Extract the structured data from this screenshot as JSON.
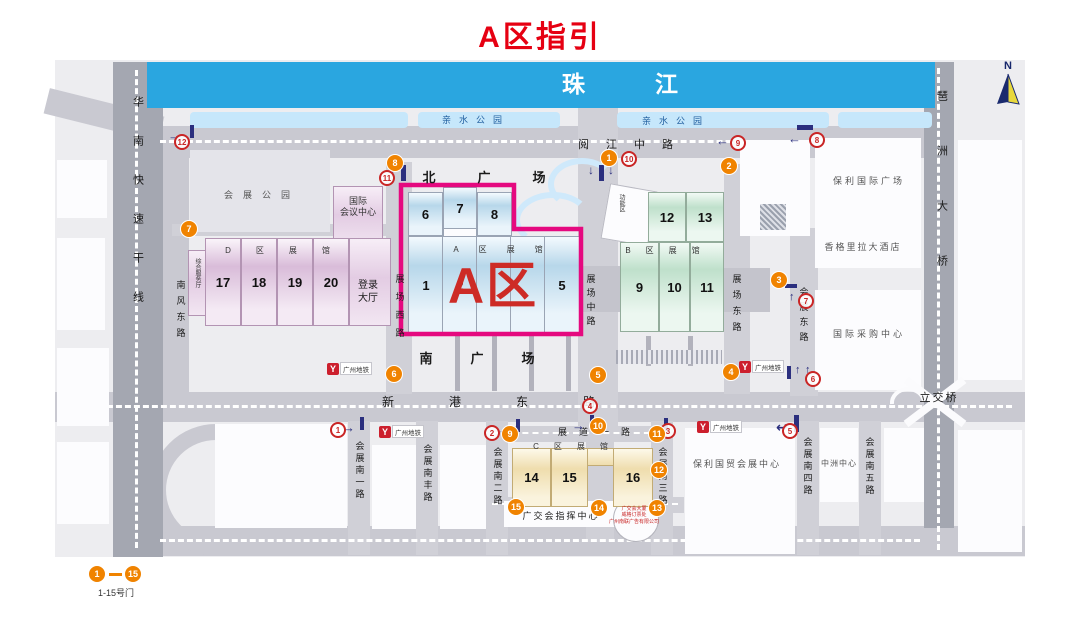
{
  "title": "A区指引",
  "legend": {
    "from": "1",
    "to": "15",
    "label": "1-15号门"
  },
  "colors": {
    "title_red": "#e60012",
    "accent_magenta": "#e5097f",
    "gate_orange": "#f08300",
    "river_blue": "#2aa6e0",
    "entry_marker_red": "#c92525",
    "arrow_navy": "#2b2f7e",
    "hall_a_blue": "#b7d7ea",
    "hall_b_green": "#bfe0cb",
    "hall_c_yellow": "#efddad",
    "hall_d_pink": "#d9bcd9"
  },
  "map": {
    "area_a_label": "A区",
    "metro": {
      "label": "广州地铁",
      "positions": [
        {
          "x": 327,
          "y": 362
        },
        {
          "x": 379,
          "y": 425
        },
        {
          "x": 739,
          "y": 360
        },
        {
          "x": 697,
          "y": 420
        }
      ]
    },
    "labels": [
      {
        "id": "pearl-river",
        "t": "珠江",
        "x": 655,
        "y": 70,
        "s": 23,
        "ls": 70,
        "c": "#ffffff",
        "b": 1
      },
      {
        "id": "waterfront-park-1",
        "t": "亲水公园",
        "x": 476,
        "y": 115,
        "s": 9,
        "ls": 8,
        "c": "#1d5c9e"
      },
      {
        "id": "waterfront-park-2",
        "t": "亲水公园",
        "x": 676,
        "y": 116,
        "s": 9,
        "ls": 8,
        "c": "#1d5c9e"
      },
      {
        "id": "yuejiang-middle-rd",
        "t": "阅江中路",
        "x": 634,
        "y": 139,
        "s": 11,
        "ls": 17
      },
      {
        "id": "huanan-expressway",
        "t": "华南快速干线",
        "x": 137,
        "y": 96,
        "s": 11,
        "ls": 28,
        "v": 1
      },
      {
        "id": "nanfeng-east-rd",
        "t": "南风东路",
        "x": 180,
        "y": 280,
        "s": 9,
        "ls": 7,
        "v": 1
      },
      {
        "id": "exhibition-park",
        "t": "会展公园",
        "x": 262,
        "y": 190,
        "s": 9,
        "ls": 10,
        "c": "#555555"
      },
      {
        "id": "intl-convention-center",
        "t": [
          "国际",
          "会议中心"
        ],
        "x": 358,
        "y": 196,
        "s": 9,
        "c": "#333333"
      },
      {
        "id": "area-d-hall-row",
        "t": "D区展馆",
        "x": 290,
        "y": 246,
        "s": 8,
        "ls": 25,
        "c": "#333333"
      },
      {
        "id": "service-hall",
        "t": "综合服务厅",
        "x": 197,
        "y": 258,
        "s": 6,
        "v": 1,
        "c": "#333333"
      },
      {
        "id": "registration-hall",
        "t": [
          "登录",
          "大厅"
        ],
        "x": 368,
        "y": 280,
        "s": 10
      },
      {
        "id": "zhanchang-west-rd",
        "t": "展场西路",
        "x": 399,
        "y": 274,
        "s": 9,
        "ls": 9,
        "v": 1
      },
      {
        "id": "north-plaza",
        "t": "北广场",
        "x": 505,
        "y": 170,
        "s": 13,
        "ls": 42,
        "b": 1
      },
      {
        "id": "area-a-hall-row",
        "t": "A区展馆",
        "x": 508,
        "y": 245,
        "s": 8,
        "ls": 20,
        "c": "#333333"
      },
      {
        "id": "zhanchang-middle-rd",
        "t": "展场中路",
        "x": 590,
        "y": 274,
        "s": 9,
        "ls": 5,
        "v": 1
      },
      {
        "id": "area-b-hall-row",
        "t": "B区展馆",
        "x": 670,
        "y": 246,
        "s": 8,
        "ls": 15,
        "c": "#333333"
      },
      {
        "id": "function-zone",
        "t": "功能区",
        "x": 621,
        "y": 194,
        "s": 6,
        "v": 1,
        "c": "#333333"
      },
      {
        "id": "zhanchang-east-rd",
        "t": "展场东路",
        "x": 736,
        "y": 274,
        "s": 9,
        "ls": 7,
        "v": 1
      },
      {
        "id": "huizhan-east-rd",
        "t": "会展东路",
        "x": 803,
        "y": 287,
        "s": 9,
        "ls": 6,
        "v": 1
      },
      {
        "id": "poly-intl-plaza",
        "t": "保利国际广场",
        "x": 869,
        "y": 176,
        "s": 9,
        "ls": 3,
        "c": "#555555"
      },
      {
        "id": "shangri-la-hotel",
        "t": "香格里拉大酒店",
        "x": 863,
        "y": 242,
        "s": 9,
        "ls": 2,
        "c": "#555555"
      },
      {
        "id": "intl-sourcing-center",
        "t": "国际采购中心",
        "x": 869,
        "y": 329,
        "s": 9,
        "ls": 3,
        "c": "#555555"
      },
      {
        "id": "pazhou-bridge",
        "t": "琶洲大桥",
        "x": 941,
        "y": 90,
        "s": 11,
        "ls": 44,
        "v": 1
      },
      {
        "id": "south-plaza",
        "t": "南广场",
        "x": 496,
        "y": 351,
        "s": 13,
        "ls": 38,
        "b": 1
      },
      {
        "id": "xingang-east-rd",
        "t": "新港东路",
        "x": 516,
        "y": 395,
        "s": 12,
        "ls": 55
      },
      {
        "id": "overpass",
        "t": "立交桥",
        "x": 939,
        "y": 392,
        "s": 11,
        "ls": 2
      },
      {
        "id": "zhandao-first-rd",
        "t": "展道一路",
        "x": 600,
        "y": 427,
        "s": 9,
        "ls": 12
      },
      {
        "id": "huizhan-south-1-rd",
        "t": "会展南一路",
        "x": 359,
        "y": 441,
        "s": 9,
        "ls": 3,
        "v": 1
      },
      {
        "id": "huizhan-south-feng-rd",
        "t": "会展南丰路",
        "x": 427,
        "y": 444,
        "s": 9,
        "ls": 3,
        "v": 1
      },
      {
        "id": "huizhan-south-2-rd",
        "t": "会展南二路",
        "x": 497,
        "y": 447,
        "s": 9,
        "ls": 3,
        "v": 1
      },
      {
        "id": "area-c-hall-row",
        "t": "C区展馆",
        "x": 578,
        "y": 442,
        "s": 8,
        "ls": 15,
        "c": "#333333"
      },
      {
        "id": "huizhan-south-3-rd",
        "t": "会展南三路",
        "x": 662,
        "y": 447,
        "s": 9,
        "ls": 3,
        "v": 1
      },
      {
        "id": "poly-trade-center",
        "t": "保利国贸会展中心",
        "x": 737,
        "y": 459,
        "s": 9,
        "ls": 2,
        "c": "#555555"
      },
      {
        "id": "huizhan-south-4-rd",
        "t": "会展南四路",
        "x": 807,
        "y": 437,
        "s": 9,
        "ls": 3,
        "v": 1
      },
      {
        "id": "zhongzhou-center",
        "t": "中洲中心",
        "x": 839,
        "y": 459,
        "s": 8,
        "ls": 1,
        "c": "#555555"
      },
      {
        "id": "huizhan-south-5-rd",
        "t": "会展南五路",
        "x": 869,
        "y": 437,
        "s": 9,
        "ls": 3,
        "v": 1
      },
      {
        "id": "fair-command-center",
        "t": "广交会指挥中心",
        "x": 561,
        "y": 511,
        "s": 9,
        "ls": 2
      },
      {
        "id": "ticket-building",
        "t": [
          "广交会大厦",
          "威格订票处",
          "广州南联广告有限公司"
        ],
        "x": 634,
        "y": 506,
        "s": 5,
        "c": "#c92525"
      },
      {
        "id": "compass-n",
        "t": "N",
        "x": 1008,
        "y": 60,
        "s": 11,
        "b": 1,
        "c": "#16266b"
      }
    ],
    "hall_groups": [
      {
        "id": "area-d",
        "cls": "hallD",
        "halls": [
          {
            "n": "17",
            "x": 205,
            "y": 238,
            "w": 34,
            "h": 86
          },
          {
            "n": "18",
            "x": 241,
            "y": 238,
            "w": 34,
            "h": 86
          },
          {
            "n": "19",
            "x": 277,
            "y": 238,
            "w": 34,
            "h": 86
          },
          {
            "n": "20",
            "x": 313,
            "y": 238,
            "w": 34,
            "h": 86
          }
        ]
      },
      {
        "id": "area-a",
        "cls": "hallA",
        "halls": [
          {
            "n": "6",
            "x": 408,
            "y": 192,
            "w": 33,
            "h": 42
          },
          {
            "n": "7",
            "x": 443,
            "y": 187,
            "w": 32,
            "h": 40
          },
          {
            "n": "8",
            "x": 477,
            "y": 192,
            "w": 33,
            "h": 42
          },
          {
            "n": "1",
            "x": 408,
            "y": 236,
            "w": 34,
            "h": 96
          },
          {
            "n": "2",
            "x": 442,
            "y": 236,
            "w": 34,
            "h": 96
          },
          {
            "n": "",
            "x": 476,
            "y": 236,
            "w": 34,
            "h": 96
          },
          {
            "n": "",
            "x": 510,
            "y": 236,
            "w": 34,
            "h": 96
          },
          {
            "n": "5",
            "x": 544,
            "y": 236,
            "w": 34,
            "h": 96
          }
        ]
      },
      {
        "id": "area-b",
        "cls": "hallB",
        "halls": [
          {
            "n": "12",
            "x": 648,
            "y": 192,
            "w": 36,
            "h": 48
          },
          {
            "n": "13",
            "x": 686,
            "y": 192,
            "w": 36,
            "h": 48
          },
          {
            "n": "9",
            "x": 620,
            "y": 242,
            "w": 37,
            "h": 88
          },
          {
            "n": "10",
            "x": 659,
            "y": 242,
            "w": 29,
            "h": 88
          },
          {
            "n": "11",
            "x": 690,
            "y": 242,
            "w": 32,
            "h": 88
          }
        ]
      },
      {
        "id": "area-c",
        "cls": "hallC",
        "halls": [
          {
            "n": "14",
            "x": 512,
            "y": 448,
            "w": 37,
            "h": 57
          },
          {
            "n": "15",
            "x": 551,
            "y": 448,
            "w": 35,
            "h": 57
          },
          {
            "n": "16",
            "x": 613,
            "y": 448,
            "w": 38,
            "h": 57
          }
        ]
      }
    ],
    "gates": [
      {
        "n": "1",
        "x": 609,
        "y": 158
      },
      {
        "n": "2",
        "x": 729,
        "y": 166
      },
      {
        "n": "3",
        "x": 779,
        "y": 280
      },
      {
        "n": "4",
        "x": 731,
        "y": 372
      },
      {
        "n": "5",
        "x": 598,
        "y": 375
      },
      {
        "n": "6",
        "x": 394,
        "y": 374
      },
      {
        "n": "7",
        "x": 189,
        "y": 229
      },
      {
        "n": "8",
        "x": 395,
        "y": 163
      },
      {
        "n": "9",
        "x": 510,
        "y": 434
      },
      {
        "n": "10",
        "x": 598,
        "y": 426
      },
      {
        "n": "11",
        "x": 657,
        "y": 434
      },
      {
        "n": "12",
        "x": 659,
        "y": 470
      },
      {
        "n": "13",
        "x": 657,
        "y": 508
      },
      {
        "n": "14",
        "x": 599,
        "y": 508
      },
      {
        "n": "15",
        "x": 516,
        "y": 507
      }
    ],
    "entry_markers": [
      {
        "n": "1",
        "x": 338,
        "y": 430
      },
      {
        "n": "2",
        "x": 492,
        "y": 433
      },
      {
        "n": "3",
        "x": 668,
        "y": 431
      },
      {
        "n": "4",
        "x": 590,
        "y": 406
      },
      {
        "n": "5",
        "x": 790,
        "y": 431
      },
      {
        "n": "6",
        "x": 813,
        "y": 379
      },
      {
        "n": "7",
        "x": 806,
        "y": 301
      },
      {
        "n": "8",
        "x": 817,
        "y": 140
      },
      {
        "n": "9",
        "x": 738,
        "y": 143
      },
      {
        "n": "10",
        "x": 629,
        "y": 159
      },
      {
        "n": "11",
        "x": 387,
        "y": 178
      },
      {
        "n": "12",
        "x": 182,
        "y": 142
      }
    ],
    "arrows": [
      {
        "g": "→",
        "x": 342,
        "y": 421,
        "s": 13
      },
      {
        "g": "→",
        "x": 498,
        "y": 423,
        "s": 13
      },
      {
        "g": "→",
        "x": 646,
        "y": 422,
        "s": 13
      },
      {
        "g": "→",
        "x": 572,
        "y": 419,
        "s": 13
      },
      {
        "g": "↩",
        "x": 776,
        "y": 420,
        "s": 14
      },
      {
        "g": "↑",
        "x": 795,
        "y": 365,
        "s": 11
      },
      {
        "g": "↑",
        "x": 805,
        "y": 365,
        "s": 11
      },
      {
        "g": "↑",
        "x": 789,
        "y": 292,
        "s": 11
      },
      {
        "g": "←",
        "x": 788,
        "y": 132,
        "s": 13
      },
      {
        "g": "←",
        "x": 716,
        "y": 134,
        "s": 13
      },
      {
        "g": "↓",
        "x": 588,
        "y": 164,
        "s": 12
      },
      {
        "g": "↓",
        "x": 608,
        "y": 164,
        "s": 12
      },
      {
        "g": "↓",
        "x": 390,
        "y": 166,
        "s": 12
      },
      {
        "g": "→",
        "x": 168,
        "y": 129,
        "s": 13
      }
    ],
    "arrow_bars": [
      {
        "x": 360,
        "y": 417,
        "w": 4,
        "h": 13
      },
      {
        "x": 516,
        "y": 419,
        "w": 4,
        "h": 13
      },
      {
        "x": 664,
        "y": 418,
        "w": 4,
        "h": 13
      },
      {
        "x": 590,
        "y": 415,
        "w": 4,
        "h": 13
      },
      {
        "x": 794,
        "y": 415,
        "w": 5,
        "h": 17
      },
      {
        "x": 787,
        "y": 366,
        "w": 4,
        "h": 13
      },
      {
        "x": 785,
        "y": 284,
        "w": 12,
        "h": 4
      },
      {
        "x": 797,
        "y": 125,
        "w": 16,
        "h": 5
      },
      {
        "x": 599,
        "y": 165,
        "w": 5,
        "h": 16
      },
      {
        "x": 401,
        "y": 165,
        "w": 5,
        "h": 16
      },
      {
        "x": 190,
        "y": 125,
        "w": 4,
        "h": 13
      }
    ]
  }
}
